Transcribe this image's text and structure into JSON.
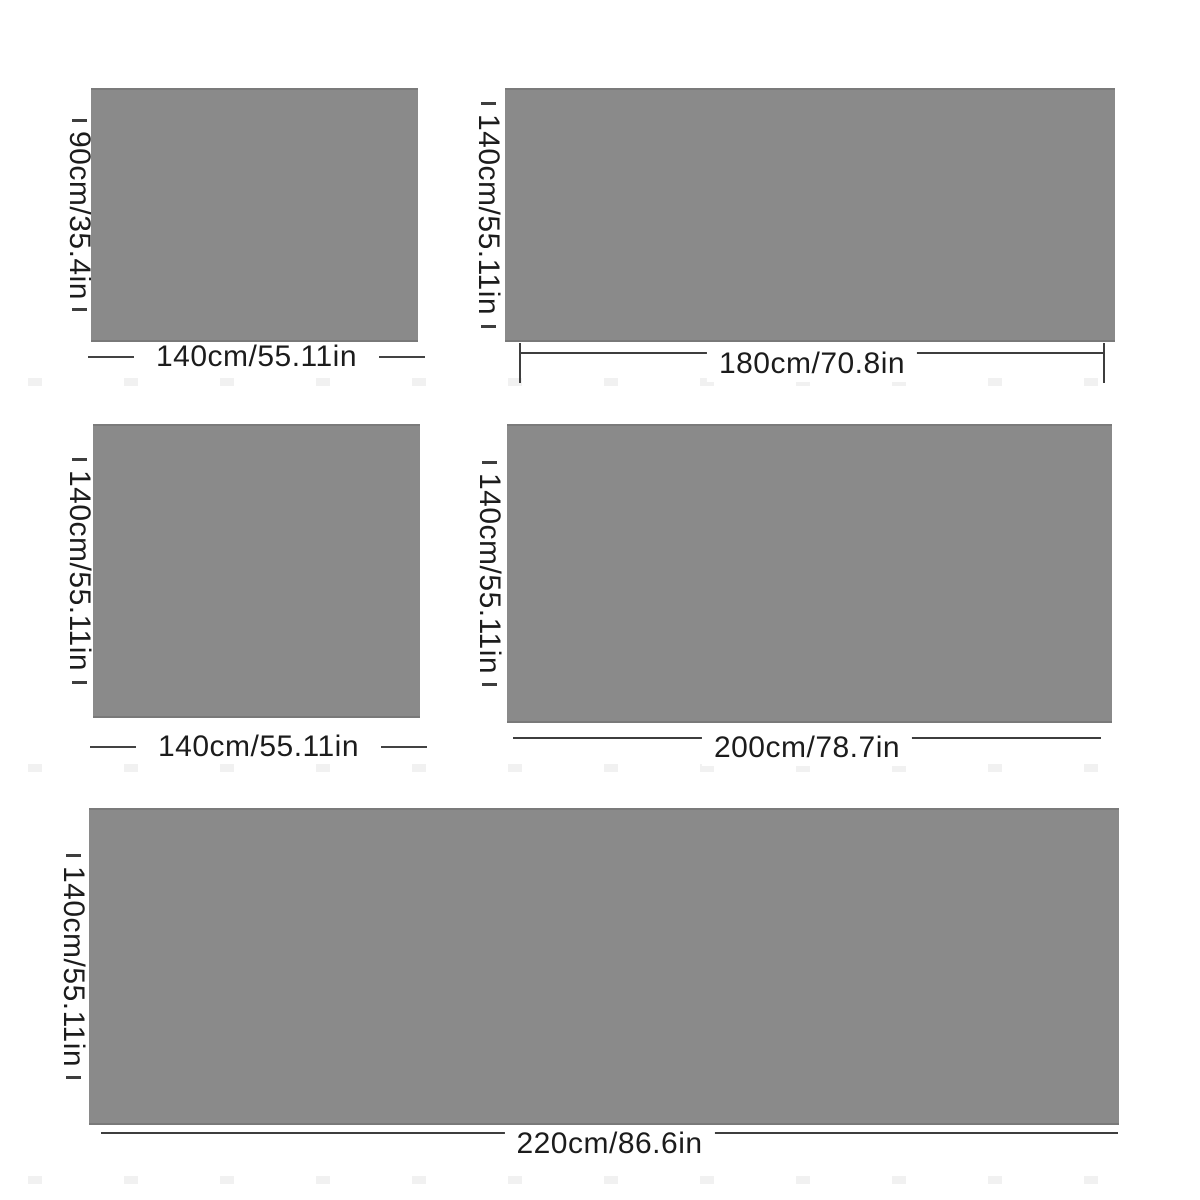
{
  "colors": {
    "background": "#ffffff",
    "swatch_gray": "#8a8a8a",
    "line": "#3e3e3e",
    "text": "#1c1c1c",
    "watermark": "#f1f1f1"
  },
  "panels": [
    {
      "id": "size-140x90",
      "height_label": "90cm/35.4in",
      "width_label": "140cm/55.11in"
    },
    {
      "id": "size-180x140",
      "height_label": "140cm/55.11in",
      "width_label": "180cm/70.8in"
    },
    {
      "id": "size-140x140",
      "height_label": "140cm/55.11in",
      "width_label": "140cm/55.11in"
    },
    {
      "id": "size-200x140",
      "height_label": "140cm/55.11in",
      "width_label": "200cm/78.7in"
    },
    {
      "id": "size-220x140",
      "height_label": "140cm/55.11in",
      "width_label": "220cm/86.6in"
    }
  ]
}
